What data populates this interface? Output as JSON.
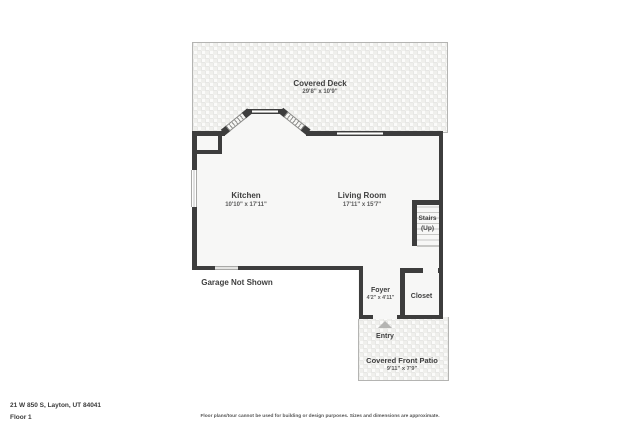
{
  "floorplan": {
    "rooms": {
      "covered_deck": {
        "name": "Covered Deck",
        "dims": "29'8\" x 10'9\""
      },
      "kitchen": {
        "name": "Kitchen",
        "dims": "10'10\" x 17'11\""
      },
      "living_room": {
        "name": "Living Room",
        "dims": "17'11\" x 15'7\""
      },
      "stairs": {
        "name": "Stairs",
        "sub": "(Up)"
      },
      "foyer": {
        "name": "Foyer",
        "dims": "4'2\" x 4'11\""
      },
      "closet": {
        "name": "Closet"
      },
      "entry": {
        "name": "Entry"
      },
      "covered_front_patio": {
        "name": "Covered Front Patio",
        "dims": "9'11\" x 7'9\""
      }
    },
    "notes": {
      "garage": "Garage Not Shown"
    },
    "icons": {
      "entry_arrow": "up-triangle"
    },
    "colors": {
      "wall": "#3d3d3d",
      "floor": "#f7f7f6",
      "outdoor_pattern": "#efefec",
      "label_text": "#3f3f3f",
      "entry_arrow": "#b5b5b3"
    }
  },
  "footer": {
    "address": "21 W 850 S, Layton, UT 84041",
    "floor_label": "Floor 1",
    "disclaimer": "Floor plans/tour cannot be used for building or design purposes. Sizes and dimensions are approximate."
  }
}
